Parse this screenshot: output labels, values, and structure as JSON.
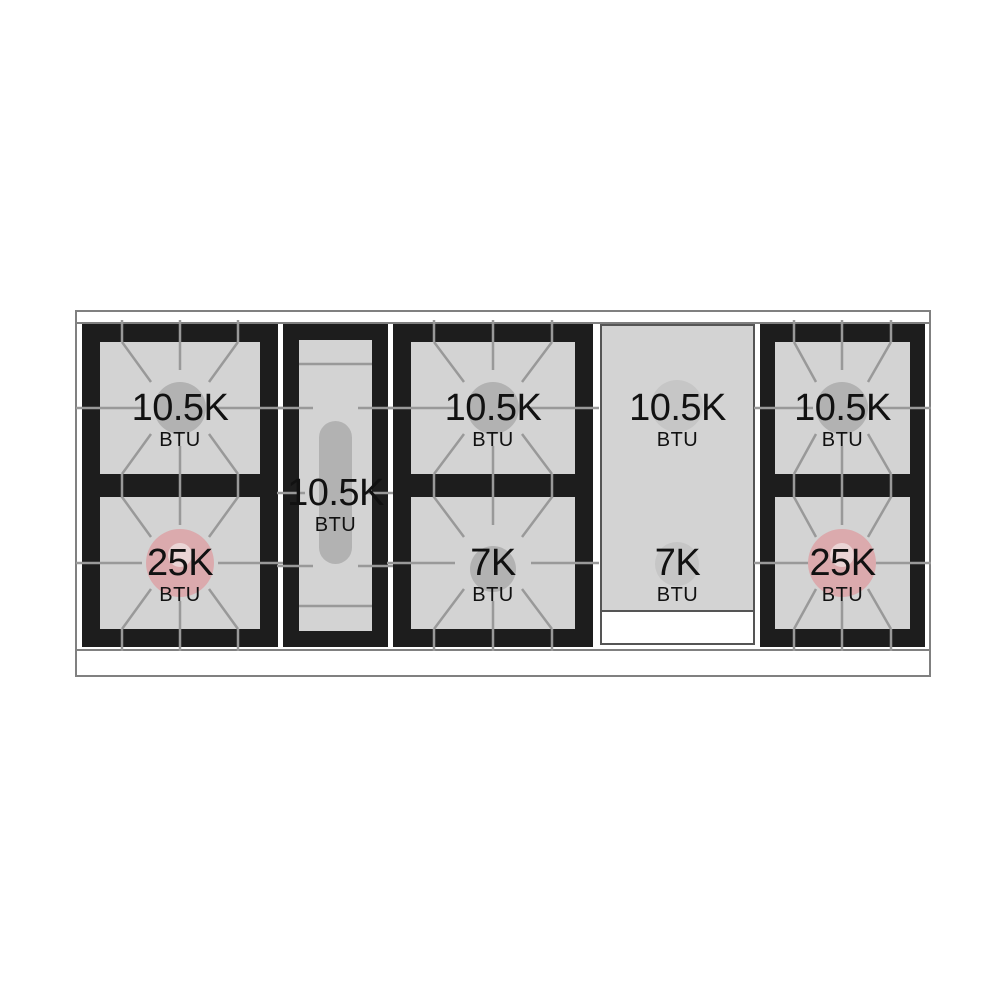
{
  "cooktop": {
    "name": "gas-range-cooktop-burner-diagram",
    "unit_label": "BTU",
    "sections": [
      {
        "id": "left-double-burner",
        "type": "double-burner",
        "burners": [
          {
            "value": "10.5K",
            "unit": "BTU",
            "cap": "gray-circle"
          },
          {
            "value": "25K",
            "unit": "BTU",
            "cap": "pink-ring"
          }
        ]
      },
      {
        "id": "center-oval-burner",
        "type": "oval-burner",
        "burners": [
          {
            "value": "10.5K",
            "unit": "BTU",
            "cap": "gray-oval"
          }
        ]
      },
      {
        "id": "middle-double-burner",
        "type": "double-burner",
        "burners": [
          {
            "value": "10.5K",
            "unit": "BTU",
            "cap": "gray-circle"
          },
          {
            "value": "7K",
            "unit": "BTU",
            "cap": "gray-circle"
          }
        ]
      },
      {
        "id": "griddle-panel",
        "type": "griddle",
        "burners": [
          {
            "value": "10.5K",
            "unit": "BTU",
            "cap": "faint-circle"
          },
          {
            "value": "7K",
            "unit": "BTU",
            "cap": "faint-circle"
          }
        ]
      },
      {
        "id": "right-double-burner",
        "type": "double-burner",
        "burners": [
          {
            "value": "10.5K",
            "unit": "BTU",
            "cap": "gray-circle"
          },
          {
            "value": "25K",
            "unit": "BTU",
            "cap": "pink-ring"
          }
        ]
      }
    ],
    "colors": {
      "surface": "#d3d3d3",
      "grate": "#1d1d1d",
      "line": "#999999",
      "cap": "#b2b2b2",
      "faint": "#c6c6c6",
      "pink": "#dbaaad",
      "pink-inner": "#ead4d5",
      "border": "#808080",
      "griddle-border": "#555555"
    }
  }
}
